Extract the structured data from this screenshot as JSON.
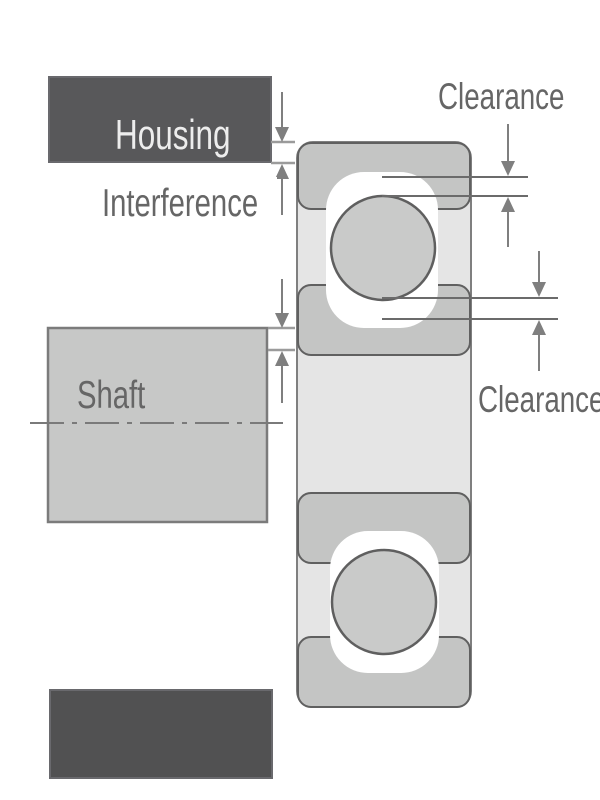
{
  "labels": {
    "housing": "Housing",
    "interference": "Interference",
    "shaft": "Shaft",
    "clearance_top": "Clearance",
    "clearance_bottom": "Clearance"
  },
  "colors": {
    "page_bg": "#ffffff",
    "housing_fill": "#58585a",
    "housing_bottom_fill": "#515152",
    "housing_stroke": "#69696d",
    "housing_text": "#ededed",
    "label_text": "#666666",
    "label_bg": "#ffffff",
    "shaft_fill": "#c7c8c7",
    "shaft_stroke": "#7b7b7b",
    "bearing_body": "#e5e5e5",
    "bearing_body_stroke": "#7f7f7f",
    "ring_fill": "#c4c5c4",
    "ring_stroke": "#606060",
    "ball_fill": "#c9cac9",
    "ball_stroke": "#5f5f5f",
    "pocket": "#ffffff",
    "dim_line": "#6b6b6b",
    "tick": "#9b9b9b",
    "arrow": "#7f7f7f",
    "centerline": "#7a7a7a"
  }
}
